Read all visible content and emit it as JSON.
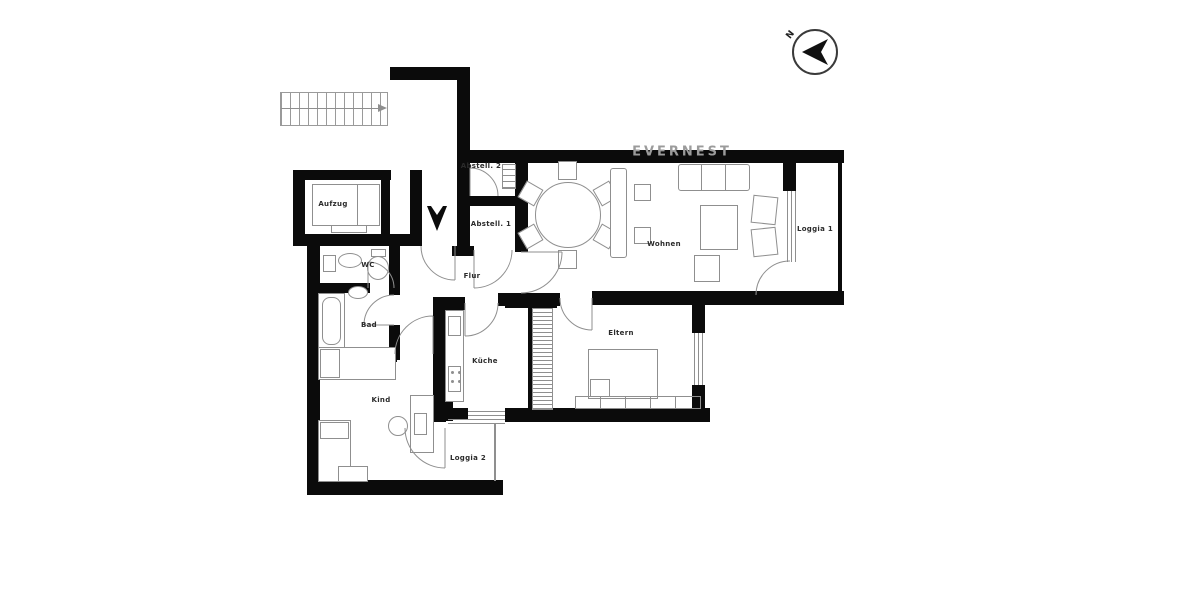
{
  "brand": "EVERNEST",
  "compass_label": "N",
  "rooms": {
    "aufzug": "Aufzug",
    "abstell2": "Abstell. 2",
    "abstell1": "Abstell. 1",
    "wc": "WC",
    "bad": "Bad",
    "flur": "Flur",
    "wohnen": "Wohnen",
    "loggia1": "Loggia 1",
    "kueche": "Küche",
    "eltern": "Eltern",
    "kind": "Kind",
    "loggia2": "Loggia 2"
  },
  "colors": {
    "wall": "#0b0b0b",
    "furniture_line": "#8f8f8f",
    "watermark": "#9b9b9b"
  }
}
